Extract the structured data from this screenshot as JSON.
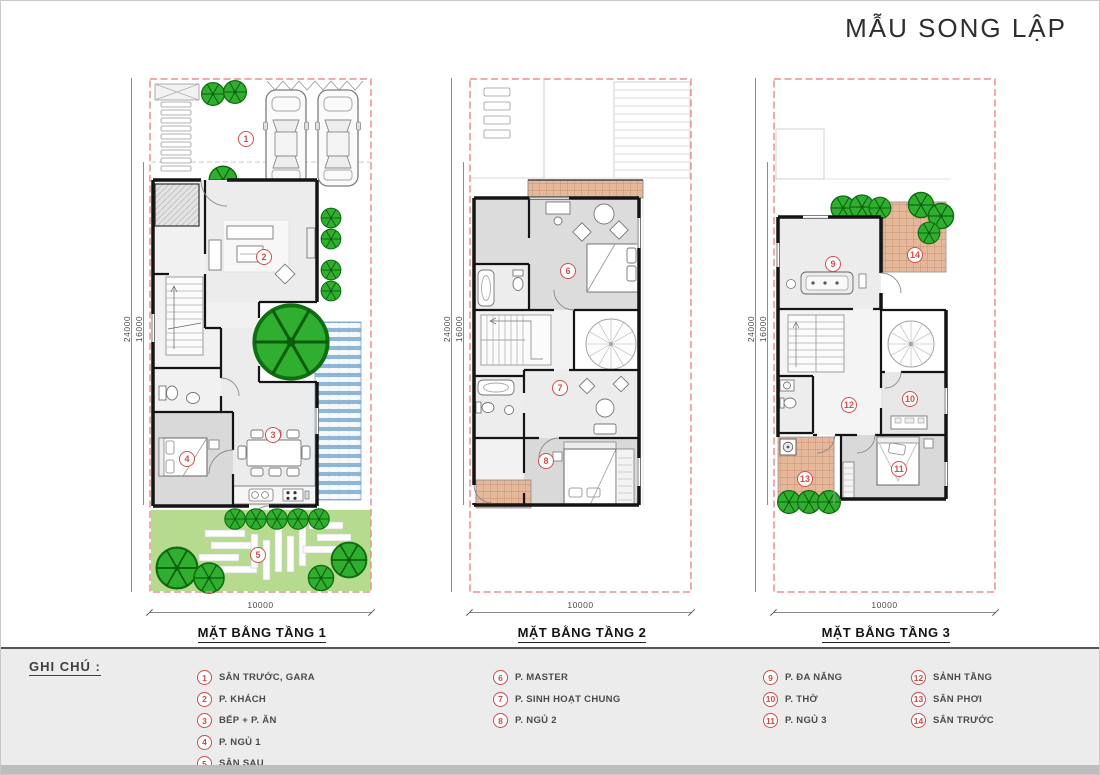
{
  "title": "MẪU SONG LẬP",
  "legend": {
    "heading": "GHI CHÚ :",
    "columns": [
      [
        {
          "n": "1",
          "label": "SÂN TRƯỚC, GARA"
        },
        {
          "n": "2",
          "label": "P. KHÁCH"
        },
        {
          "n": "3",
          "label": "BẾP + P. ĂN"
        },
        {
          "n": "4",
          "label": "P. NGỦ 1"
        },
        {
          "n": "5",
          "label": "SÂN SAU"
        }
      ],
      [
        {
          "n": "6",
          "label": "P. MASTER"
        },
        {
          "n": "7",
          "label": "P. SINH HOẠT CHUNG"
        },
        {
          "n": "8",
          "label": "P. NGỦ 2"
        }
      ],
      [
        {
          "n": "9",
          "label": "P. ĐA NĂNG"
        },
        {
          "n": "10",
          "label": "P. THỜ"
        },
        {
          "n": "11",
          "label": "P. NGỦ 3"
        }
      ],
      [
        {
          "n": "12",
          "label": "SẢNH TẦNG"
        },
        {
          "n": "13",
          "label": "SÂN PHƠI"
        },
        {
          "n": "14",
          "label": "SÂN TRƯỚC"
        }
      ]
    ]
  },
  "plans": [
    {
      "name": "MẶT BẰNG TẦNG 1",
      "dim_lot_depth": "24000",
      "dim_house_depth": "16000",
      "dim_width": "10000",
      "markers": [
        {
          "n": "1",
          "x": 97,
          "y": 61
        },
        {
          "n": "2",
          "x": 115,
          "y": 179
        },
        {
          "n": "3",
          "x": 124,
          "y": 357
        },
        {
          "n": "4",
          "x": 38,
          "y": 381
        },
        {
          "n": "5",
          "x": 109,
          "y": 477
        }
      ]
    },
    {
      "name": "MẶT BẰNG TẦNG 2",
      "dim_lot_depth": "24000",
      "dim_house_depth": "16000",
      "dim_width": "10000",
      "markers": [
        {
          "n": "6",
          "x": 99,
          "y": 193
        },
        {
          "n": "7",
          "x": 91,
          "y": 310
        },
        {
          "n": "8",
          "x": 77,
          "y": 383
        }
      ]
    },
    {
      "name": "MẶT BẰNG TẦNG 3",
      "dim_lot_depth": "24000",
      "dim_house_depth": "16000",
      "dim_width": "10000",
      "markers": [
        {
          "n": "9",
          "x": 60,
          "y": 186
        },
        {
          "n": "10",
          "x": 137,
          "y": 321
        },
        {
          "n": "11",
          "x": 126,
          "y": 391
        },
        {
          "n": "12",
          "x": 76,
          "y": 327
        },
        {
          "n": "13",
          "x": 32,
          "y": 401
        },
        {
          "n": "14",
          "x": 142,
          "y": 177
        }
      ]
    }
  ],
  "colors": {
    "boundary": "#e89090",
    "marker": "#cf4f4f",
    "tree": "#2fae2f",
    "lawn": "#b7db8e",
    "water": "#8fb6d6",
    "tile": "#e5b79b"
  }
}
